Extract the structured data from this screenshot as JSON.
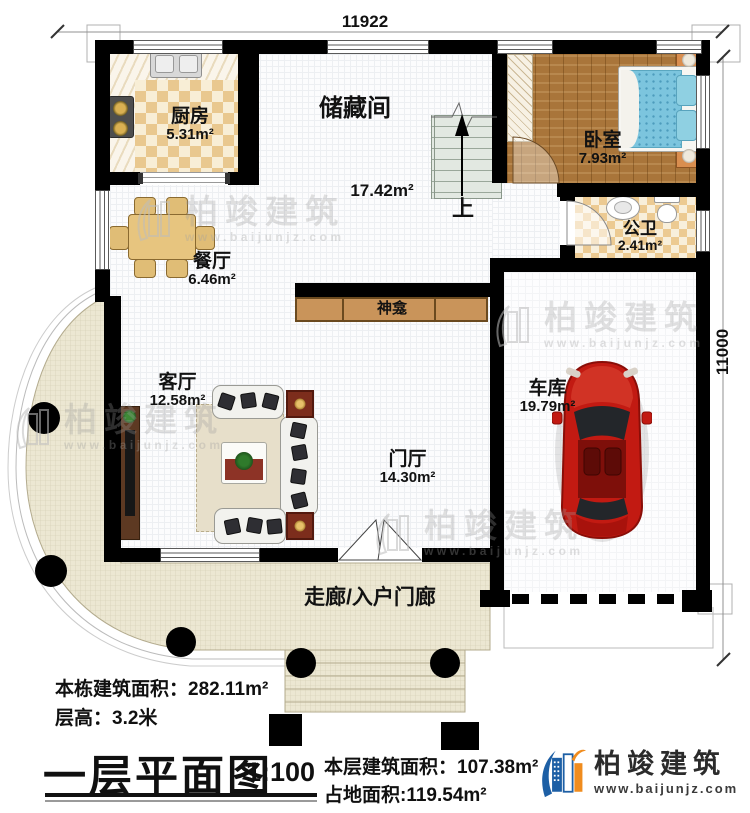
{
  "plan": {
    "dimension_top": "11922",
    "dimension_right": "11000",
    "rooms": {
      "kitchen": {
        "name": "厨房",
        "area": "5.31m²"
      },
      "storage": {
        "name": "储藏间",
        "area": "17.42m²"
      },
      "bedroom": {
        "name": "卧室",
        "area": "7.93m²"
      },
      "bathroom": {
        "name": "公卫",
        "area": "2.41m²"
      },
      "dining": {
        "name": "餐厅",
        "area": "6.46m²"
      },
      "living": {
        "name": "客厅",
        "area": "12.58m²"
      },
      "foyer": {
        "name": "门厅",
        "area": "14.30m²"
      },
      "garage": {
        "name": "车库",
        "area": "19.79m²"
      },
      "shrine": {
        "name": "神龛"
      },
      "porch": {
        "name": "走廊/入户门廊"
      }
    },
    "stairs_label": "上"
  },
  "info": {
    "building_area_label": "本栋建筑面积：",
    "building_area_value": "282.11m²",
    "floor_height_label": "层高：",
    "floor_height_value": "3.2米",
    "level_area_label": "本层建筑面积：",
    "level_area_value": "107.38m²",
    "land_area_label": "占地面积:",
    "land_area_value": "119.54m²"
  },
  "title": {
    "text": "一层平面图",
    "scale": "1:100"
  },
  "brand": {
    "name": "柏竣建筑",
    "website": "www.baijunjz.com"
  },
  "watermark": {
    "text": "柏竣建筑",
    "website": "www.baijunjz.com"
  },
  "colors": {
    "wall": "#000000",
    "porch": "#ece7d2",
    "wood_floor": "#a9753a",
    "checker_tan": "#e9c88f",
    "car_red": "#c21a12",
    "logo_blue": "#1d5fa5",
    "logo_orange": "#f08c1e"
  }
}
